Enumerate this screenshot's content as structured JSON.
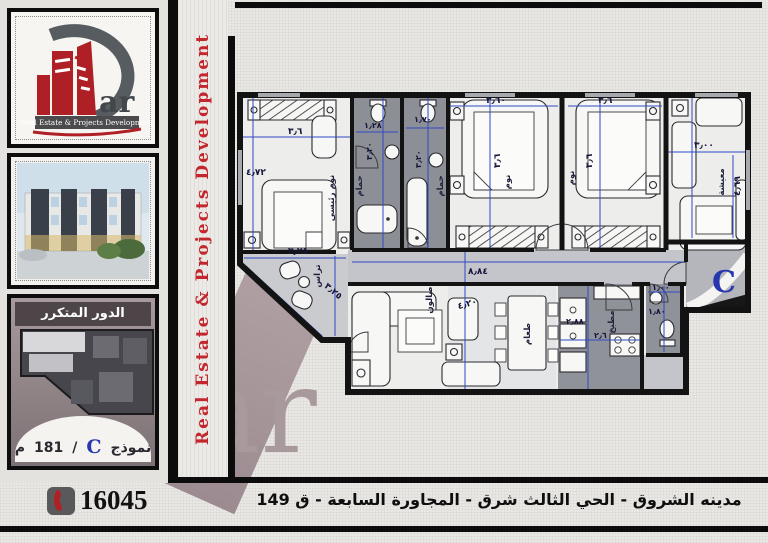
{
  "branding": {
    "logo_ar": "ar",
    "logo_banner": "Real Estate & Projects Development",
    "vertical_text": "Real Estate & Projects Development",
    "watermark_ar": "ar"
  },
  "sidebar": {
    "floor_panel": {
      "title": "الدور المتكرر",
      "model_label": "نموذج",
      "model_letter": "C",
      "separator": "/",
      "area_value": "181",
      "area_unit": "م"
    }
  },
  "footer": {
    "phone": "16045",
    "address": "مدينه الشروق - الحي الثالث شرق - المجاورة السابعة - ق 149"
  },
  "plan": {
    "marker_letter": "C",
    "rooms": {
      "master": "نوم رئيسي",
      "bath1": "حمام",
      "bath2": "حمام",
      "bed2": "نوم",
      "bed3": "نوم",
      "living": "معيشة",
      "salon": "صالون",
      "dining": "طعام",
      "kitchen": "مطبخ",
      "terrace": "تراس"
    },
    "dims": {
      "master_w": "٣٫٦",
      "master_h": "٤٫٧٢",
      "bath1_w": "١٫٢٨",
      "bath1_h": "٣٫٢٠",
      "bath2_w": "١٫٧٠",
      "bath2_h": "٣٫٢٠",
      "bed2_w": "٣٫٦٠",
      "bed2_h": "٣٫٦",
      "bed3_w": "٣٫٦",
      "bed3_h": "٣٫٦",
      "living_w": "٣٫٠٠",
      "living_h": "٤٫٦٩",
      "salon_w": "٨٫٨٤",
      "salon_h": "٤٫٢٠",
      "terrace_a": "٣٫٢٥",
      "terrace_b": "٣٫٢٥",
      "kitchen_w": "٢٫٨٨",
      "kitchen_h": "٢٫٦",
      "wc_w": "١٫٠٠",
      "wc_h": "١٫٨٠"
    }
  },
  "colors": {
    "accent_red": "#c3272e",
    "dim_blue": "#2e49c5",
    "watermark_mauve": "#a89a9c"
  }
}
